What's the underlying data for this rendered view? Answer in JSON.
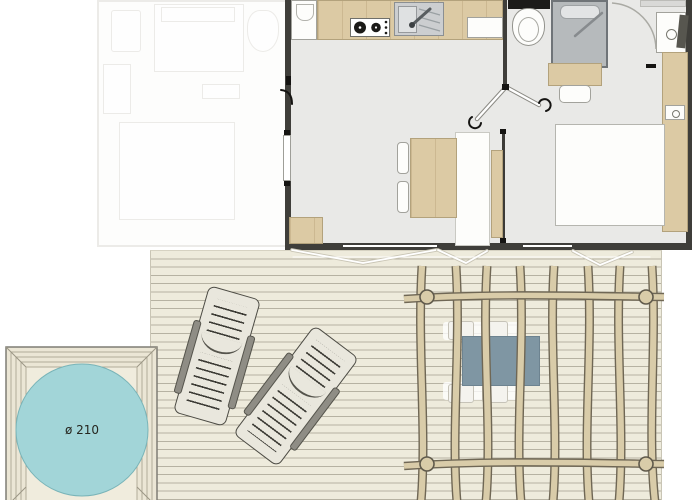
{
  "hot_tub": {
    "diameter_label": "ø 210"
  },
  "colors": {
    "wall": "#3f3e3a",
    "floor": "#e9e9e7",
    "wood": "#dccaa4",
    "wood-border": "#b3a27c",
    "deck": "#eeebdc",
    "deck-line": "#b6b2a2",
    "pergola-wood": "#d9cca9",
    "pergola-outline": "#6f6755",
    "shower": "#b6babc",
    "shower-border": "#6f7478",
    "water": "#a2d5d8",
    "tub-frame": "#ebe6d5",
    "tub-frame-line": "#b2ac99",
    "table": "#7f96a3",
    "lounger": "#e9e7dd",
    "lounger-outline": "#4c4b44"
  },
  "areas": {
    "adjacent_unit": "ghost-unit",
    "main_unit": "main-unit",
    "kitchen": "kitchen",
    "bathroom": "bathroom",
    "bedroom": "bedroom",
    "living_dining": "living-dining",
    "terrace": "deck",
    "pergola": "pergola",
    "hot_tub": "hot-tub"
  }
}
